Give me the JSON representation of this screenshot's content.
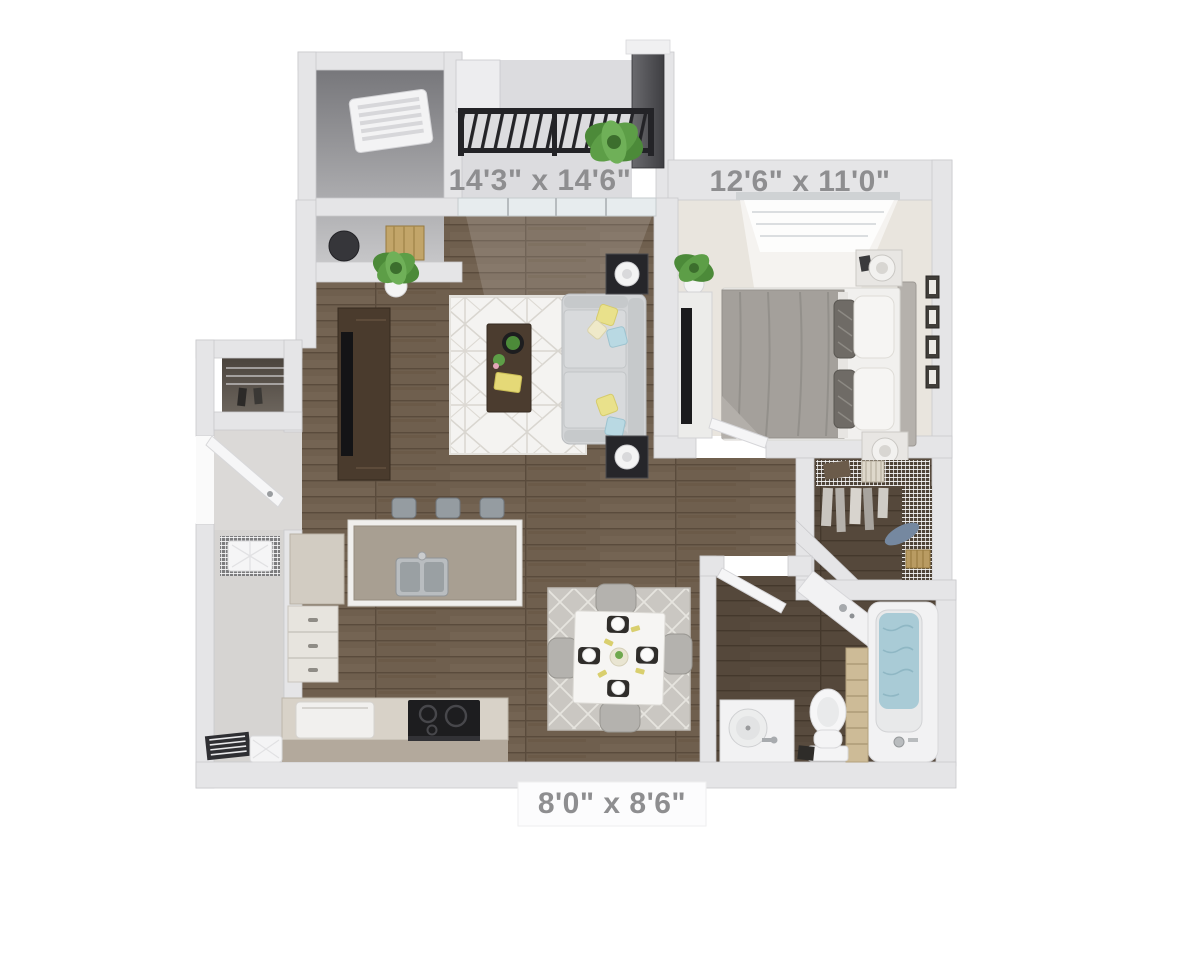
{
  "image": {
    "kind": "3d-floor-plan-rendering",
    "background_color": "#ffffff"
  },
  "dimension_labels": {
    "living_room": "14'3\" x 14'6\"",
    "bedroom": "12'6\" x 11'0\"",
    "kitchen": "8'0\" x 8'6\""
  },
  "rooms": [
    {
      "id": "balcony"
    },
    {
      "id": "utility-closet"
    },
    {
      "id": "living-room",
      "dimensions": "14'3\" x 14'6\""
    },
    {
      "id": "bedroom",
      "dimensions": "12'6\" x 11'0\""
    },
    {
      "id": "walk-in-closet"
    },
    {
      "id": "bathroom"
    },
    {
      "id": "kitchen",
      "dimensions": "8'0\" x 8'6\""
    },
    {
      "id": "dining-area"
    },
    {
      "id": "entry"
    },
    {
      "id": "laundry-corridor"
    }
  ],
  "palette": {
    "wall": "#e5e5e7",
    "wood_floor": "#6f5f4e",
    "dark_wood_floor": "#55483b",
    "carpet": "#e9e5de",
    "living_rug": "#f4f3f1",
    "dining_rug": "#cac7c2",
    "sofa": "#d2d4d6",
    "pillow_yellow": "#e9e18b",
    "pillow_blue": "#b9d9e3",
    "plant_green": "#4c8a39",
    "tub_water": "#a9cbd6",
    "railing": "#232327"
  }
}
